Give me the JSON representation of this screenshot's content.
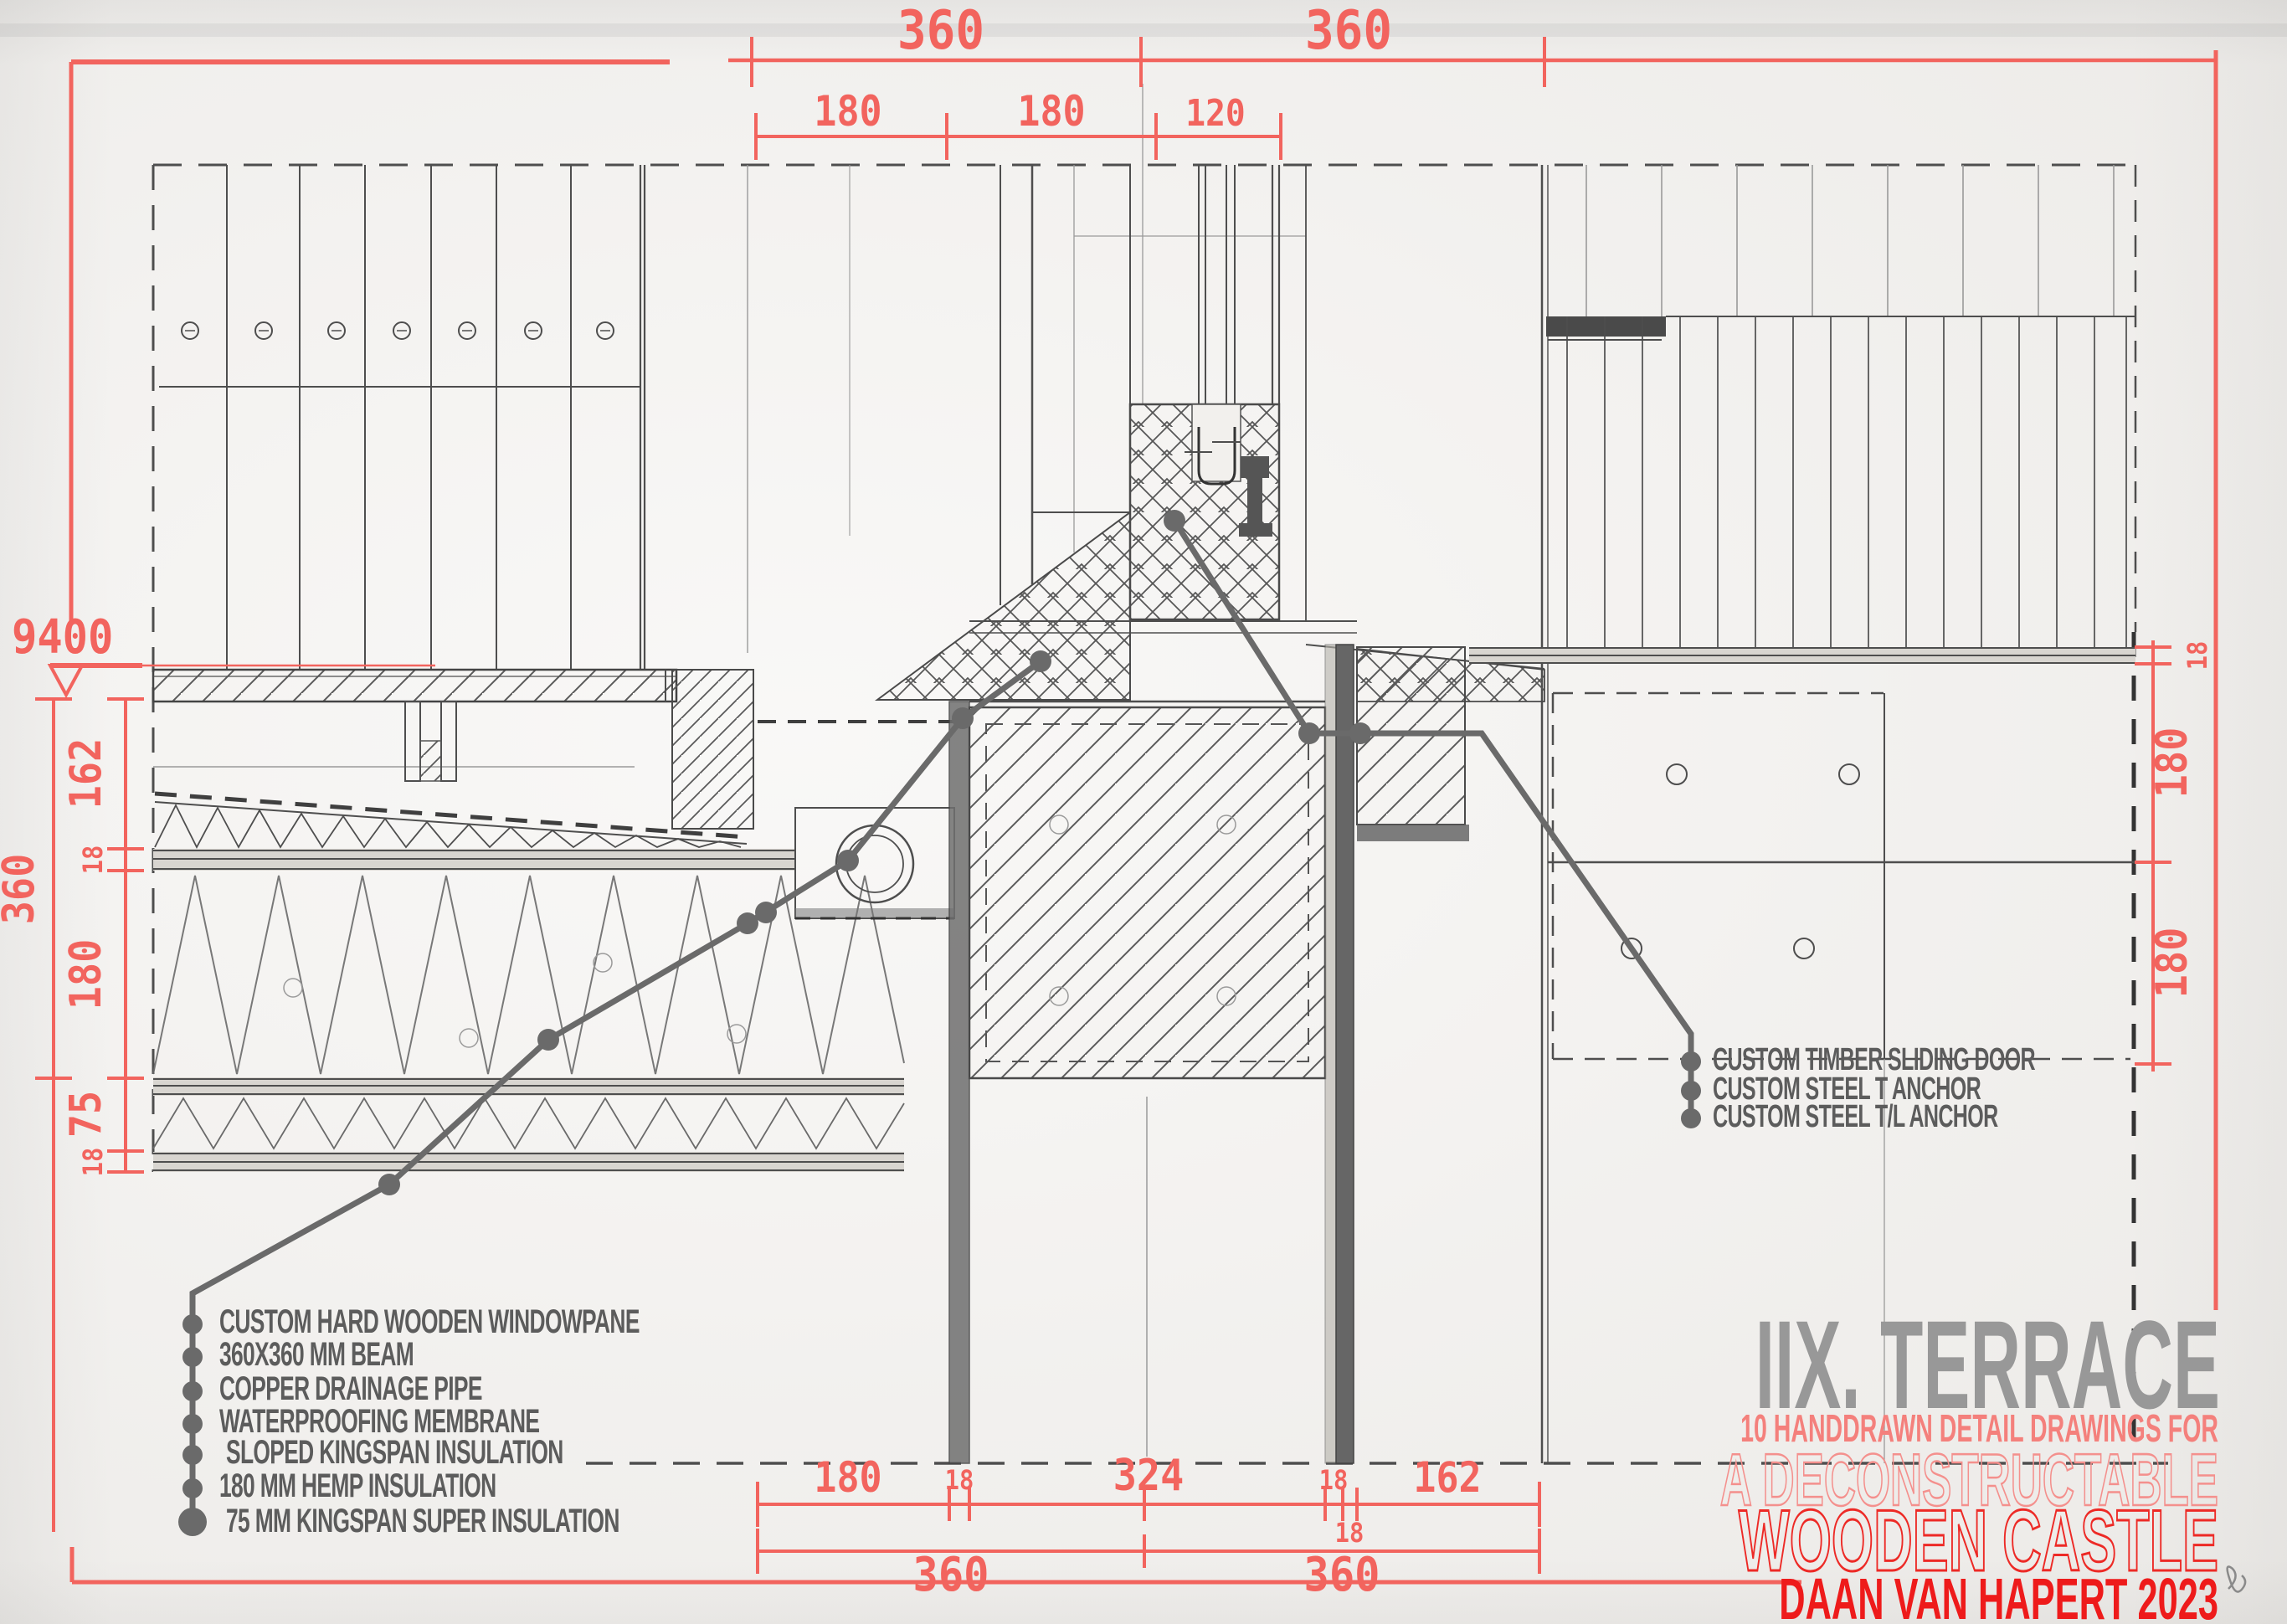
{
  "dimensions": {
    "top": {
      "row1": [
        "360",
        "360"
      ],
      "row2": [
        "180",
        "180",
        "120"
      ]
    },
    "left": {
      "level": "9400",
      "overall": "360",
      "chain": [
        "162",
        "18",
        "180",
        "75",
        "18"
      ]
    },
    "right": {
      "chain": [
        "18",
        "180",
        "180"
      ]
    },
    "bottom": {
      "row1": [
        "180",
        "18",
        "324",
        "18",
        "18",
        "162"
      ],
      "row2": [
        "360",
        "360"
      ]
    }
  },
  "legend": {
    "items": [
      "CUSTOM HARD WOODEN WINDOWPANE",
      "360X360 MM BEAM",
      "COPPER DRAINAGE PIPE",
      "WATERPROOFING MEMBRANE",
      "SLOPED KINGSPAN INSULATION",
      "180 MM HEMP INSULATION",
      "75 MM KINGSPAN SUPER INSULATION"
    ]
  },
  "callouts": {
    "items": [
      "CUSTOM TIMBER SLIDING DOOR",
      "CUSTOM STEEL T ANCHOR",
      "CUSTOM STEEL T/L ANCHOR"
    ]
  },
  "title_block": {
    "title": "IIX. TERRACE",
    "subtitle": "10 HANDDRAWN DETAIL DRAWINGS FOR",
    "line1": "A DECONSTRUCTABLE",
    "line2": "WOODEN CASTLE",
    "credit": "DAAN VAN HAPERT 2023"
  },
  "colors": {
    "dim_red": "#f2645e",
    "bright_red": "#ee1b1b",
    "outline_red": "#ed2a26",
    "salmon_outline": "#f4908d",
    "salmon_solid": "#f4807c",
    "leader_gray": "#6a6a6a",
    "legend_text_gray": "#5c5c5c",
    "title_gray": "#989898",
    "pencil_gray": "#4e4e4e"
  }
}
